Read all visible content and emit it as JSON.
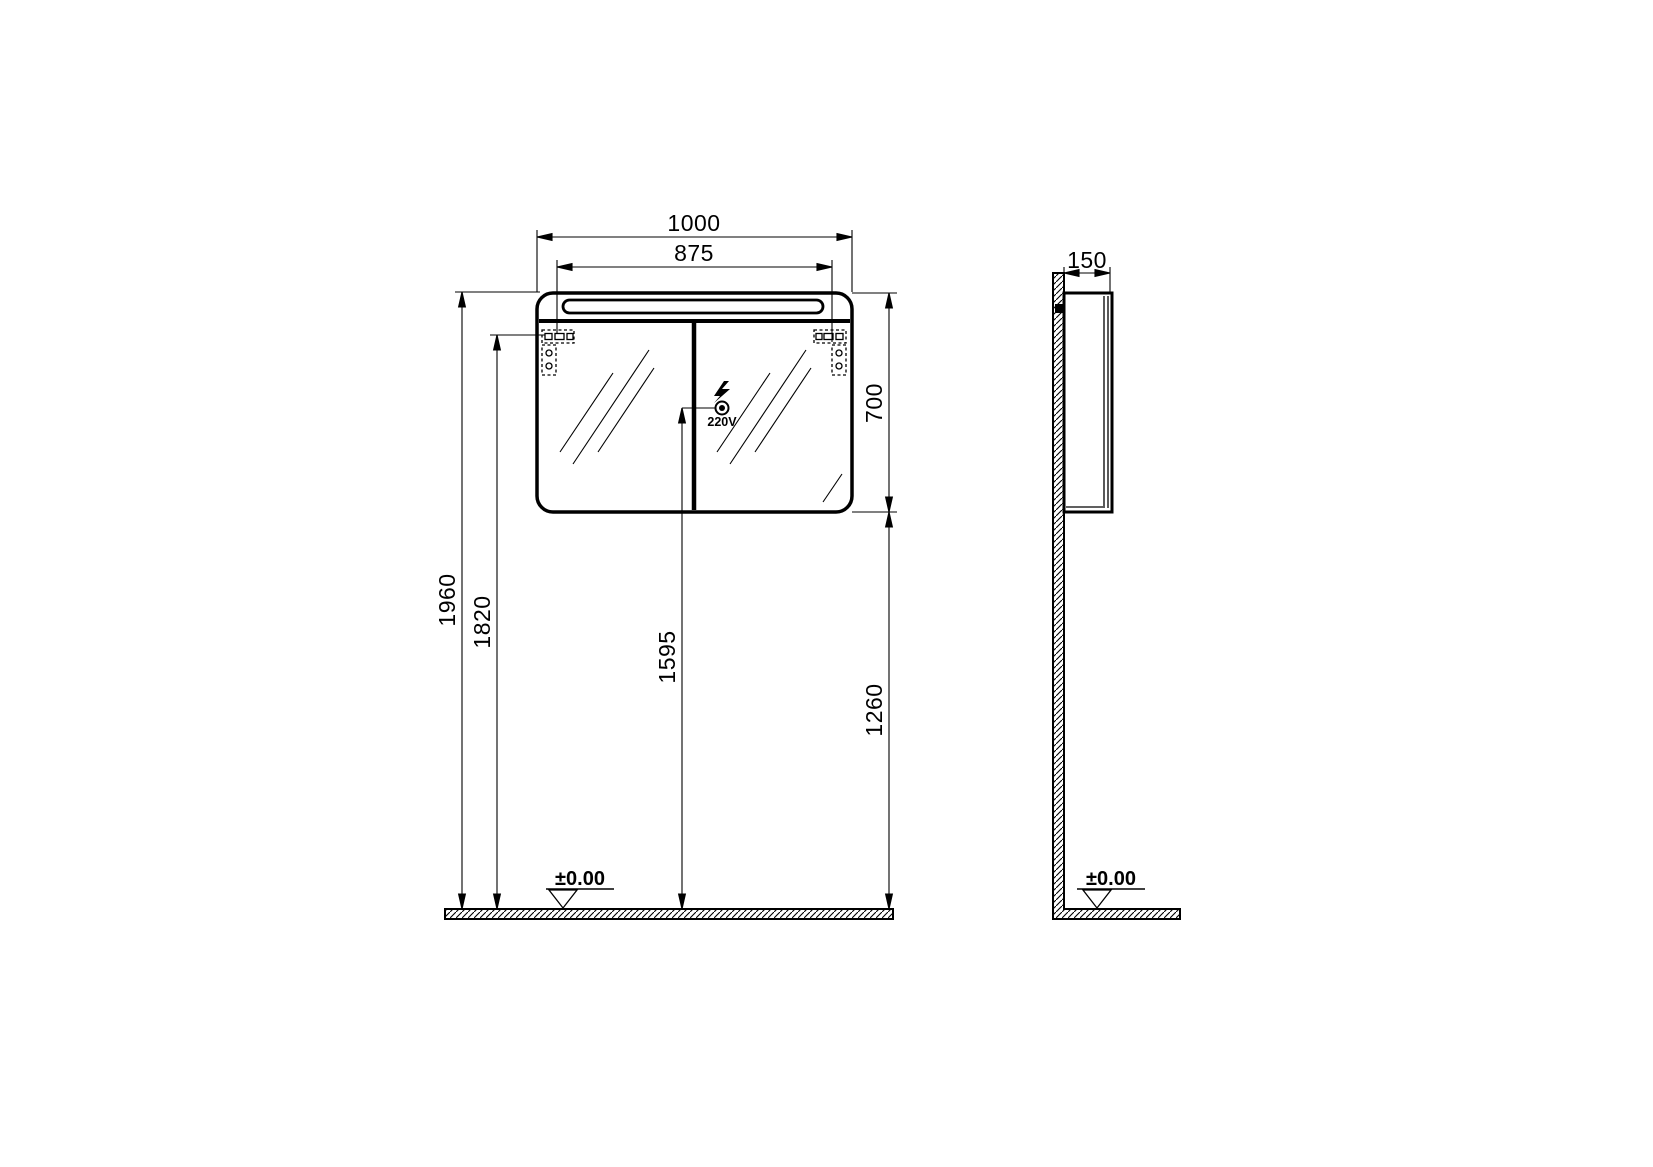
{
  "title": "Mirror cabinet installation drawing",
  "colors": {
    "line": "#000000",
    "background": "#ffffff"
  },
  "front_view": {
    "dim_width_total": "1000",
    "dim_width_mounting": "875",
    "dim_cabinet_height": "700",
    "dim_height_total": "1960",
    "dim_height_mounting": "1820",
    "dim_height_outlet": "1595",
    "dim_height_cabinet_bottom": "1260",
    "outlet_label": "220V",
    "floor_level_label": "±0.00"
  },
  "side_view": {
    "dim_depth": "150",
    "floor_level_label": "±0.00"
  }
}
